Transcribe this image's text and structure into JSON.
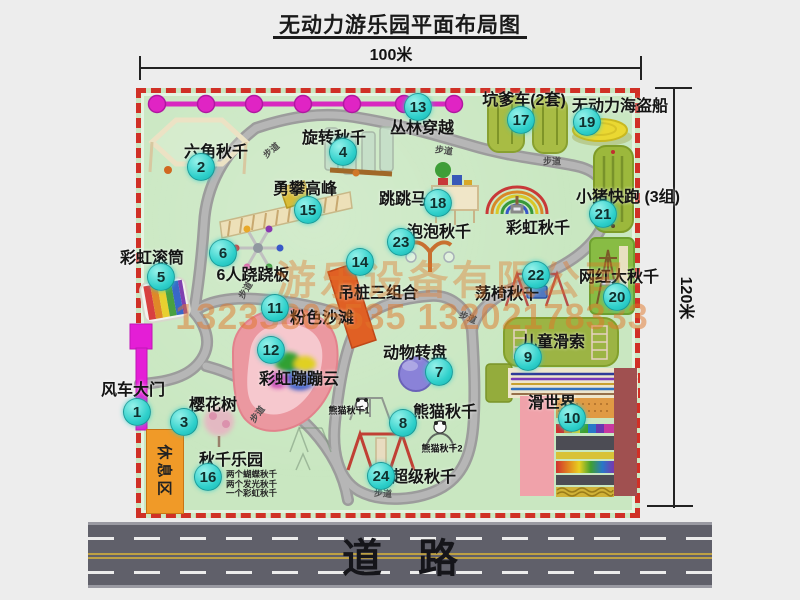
{
  "title": "无动力游乐园平面布局图",
  "dimensions": {
    "top": "100米",
    "right": "120米"
  },
  "road_label": "道路",
  "watermark": {
    "company": "游乐设备有限公司",
    "phone": "13233806535 13202178333"
  },
  "rest_area_label": "休息区",
  "trail_label": "步道",
  "trail_positions": [
    {
      "x": 271,
      "y": 150,
      "r": -40
    },
    {
      "x": 444,
      "y": 150,
      "r": 8
    },
    {
      "x": 552,
      "y": 161,
      "r": 0
    },
    {
      "x": 245,
      "y": 290,
      "r": -58
    },
    {
      "x": 468,
      "y": 317,
      "r": 22
    },
    {
      "x": 257,
      "y": 414,
      "r": -52
    },
    {
      "x": 383,
      "y": 493,
      "r": 4
    }
  ],
  "attractions": [
    {
      "num": 1,
      "name": "风车大门",
      "cx": 137,
      "cy": 412,
      "lx": 133,
      "ly": 388
    },
    {
      "num": 2,
      "name": "六角秋千",
      "cx": 201,
      "cy": 167,
      "lx": 216,
      "ly": 150
    },
    {
      "num": 3,
      "name": "樱花树",
      "cx": 184,
      "cy": 422,
      "lx": 213,
      "ly": 403
    },
    {
      "num": 4,
      "name": "旋转秋千",
      "cx": 343,
      "cy": 152,
      "lx": 334,
      "ly": 136
    },
    {
      "num": 5,
      "name": "彩虹滚筒",
      "cx": 161,
      "cy": 277,
      "lx": 152,
      "ly": 256
    },
    {
      "num": 6,
      "name": "6人跷跷板",
      "cx": 223,
      "cy": 253,
      "lx": 253,
      "ly": 273
    },
    {
      "num": 7,
      "name": "动物转盘",
      "cx": 439,
      "cy": 372,
      "lx": 415,
      "ly": 351
    },
    {
      "num": 8,
      "name": "熊猫秋千",
      "cx": 403,
      "cy": 423,
      "lx": 445,
      "ly": 410
    },
    {
      "num": 9,
      "name": "儿童滑索",
      "cx": 528,
      "cy": 357,
      "lx": 553,
      "ly": 340
    },
    {
      "num": 10,
      "name": "滑世界",
      "cx": 572,
      "cy": 418,
      "lx": 552,
      "ly": 401
    },
    {
      "num": 11,
      "name": "粉色沙滩",
      "cx": 275,
      "cy": 308,
      "lx": 322,
      "ly": 316
    },
    {
      "num": 12,
      "name": "彩虹蹦蹦云",
      "cx": 271,
      "cy": 350,
      "lx": 299,
      "ly": 377
    },
    {
      "num": 13,
      "name": "丛林穿越",
      "cx": 418,
      "cy": 107,
      "lx": 422,
      "ly": 126
    },
    {
      "num": 14,
      "name": "吊桩三组合",
      "cx": 360,
      "cy": 262,
      "lx": 378,
      "ly": 291
    },
    {
      "num": 15,
      "name": "勇攀高峰",
      "cx": 308,
      "cy": 210,
      "lx": 305,
      "ly": 187
    },
    {
      "num": 16,
      "name": "秋千乐园",
      "cx": 208,
      "cy": 477,
      "lx": 231,
      "ly": 458
    },
    {
      "num": 17,
      "name": "坑爹车(2套)",
      "cx": 521,
      "cy": 120,
      "lx": 524,
      "ly": 98
    },
    {
      "num": 18,
      "name": "跳跳马",
      "cx": 438,
      "cy": 203,
      "lx": 403,
      "ly": 197
    },
    {
      "num": 19,
      "name": "无动力海盗船",
      "cx": 587,
      "cy": 122,
      "lx": 620,
      "ly": 104
    },
    {
      "num": 20,
      "name": "网红大秋千",
      "cx": 617,
      "cy": 297,
      "lx": 619,
      "ly": 275
    },
    {
      "num": 21,
      "name": "小猪快跑 (3组)",
      "cx": 603,
      "cy": 214,
      "lx": 628,
      "ly": 195
    },
    {
      "num": 22,
      "name": "荡椅秋千",
      "cx": 536,
      "cy": 275,
      "lx": 507,
      "ly": 292
    },
    {
      "num": 23,
      "name": "泡泡秋千",
      "cx": 401,
      "cy": 242,
      "lx": 439,
      "ly": 230
    },
    {
      "num": 24,
      "name": "超级秋千",
      "cx": 381,
      "cy": 476,
      "lx": 424,
      "ly": 475
    }
  ],
  "extra_labels": [
    {
      "name": "彩虹秋千",
      "x": 538,
      "y": 226,
      "small": false
    },
    {
      "name": "熊猫秋千1",
      "x": 349,
      "y": 410,
      "small": true
    },
    {
      "name": "熊猫秋千2",
      "x": 442,
      "y": 448,
      "small": true
    }
  ],
  "swing_park_notes": [
    "两个蝴蝶秋千",
    "两个发光秋千",
    "一个彩虹秋千"
  ],
  "colors": {
    "map_green": "#c9e7c1",
    "border_red": "#d03026",
    "path_gray": "#9c9c9c",
    "marker_cyan": "#2fd0cb",
    "gate_magenta": "#e41ed6",
    "zipline_pink": "#d828c0",
    "watermark_orange": "#e07628",
    "road_gray": "#60606a",
    "rest_orange": "#f09a28"
  }
}
